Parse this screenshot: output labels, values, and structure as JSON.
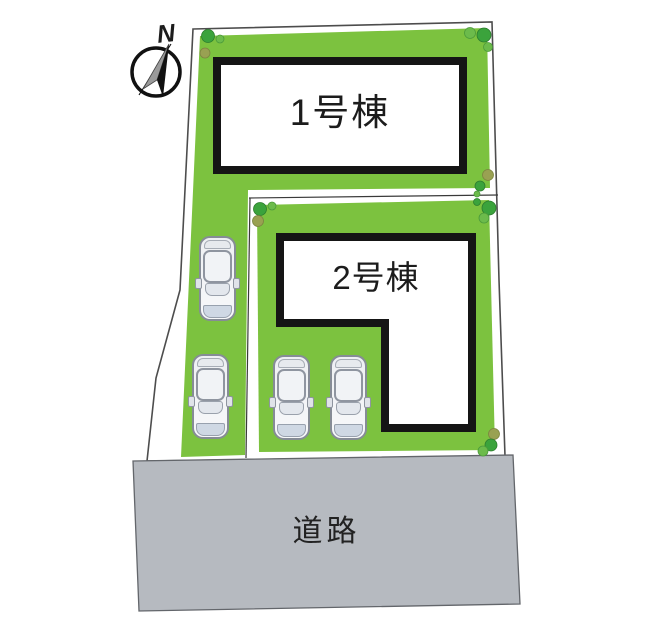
{
  "compass": {
    "north_label": "N"
  },
  "lots": {
    "building1": {
      "label": "1号棟"
    },
    "building2": {
      "label": "2号棟"
    }
  },
  "road": {
    "label": "道路"
  },
  "parking": {
    "car_count": 4
  },
  "colors": {
    "lawn": "#7cc23f",
    "road_surface": "#b6bac0",
    "shrub_dark": "#3ba33c",
    "shrub_light": "#6cbb4b",
    "shrub_olive": "#99a152",
    "building_border": "#151515",
    "boundary_line": "#4d4d4d",
    "car_body": "#f4f5f7",
    "car_front_bumper": "#cfd8e4"
  }
}
